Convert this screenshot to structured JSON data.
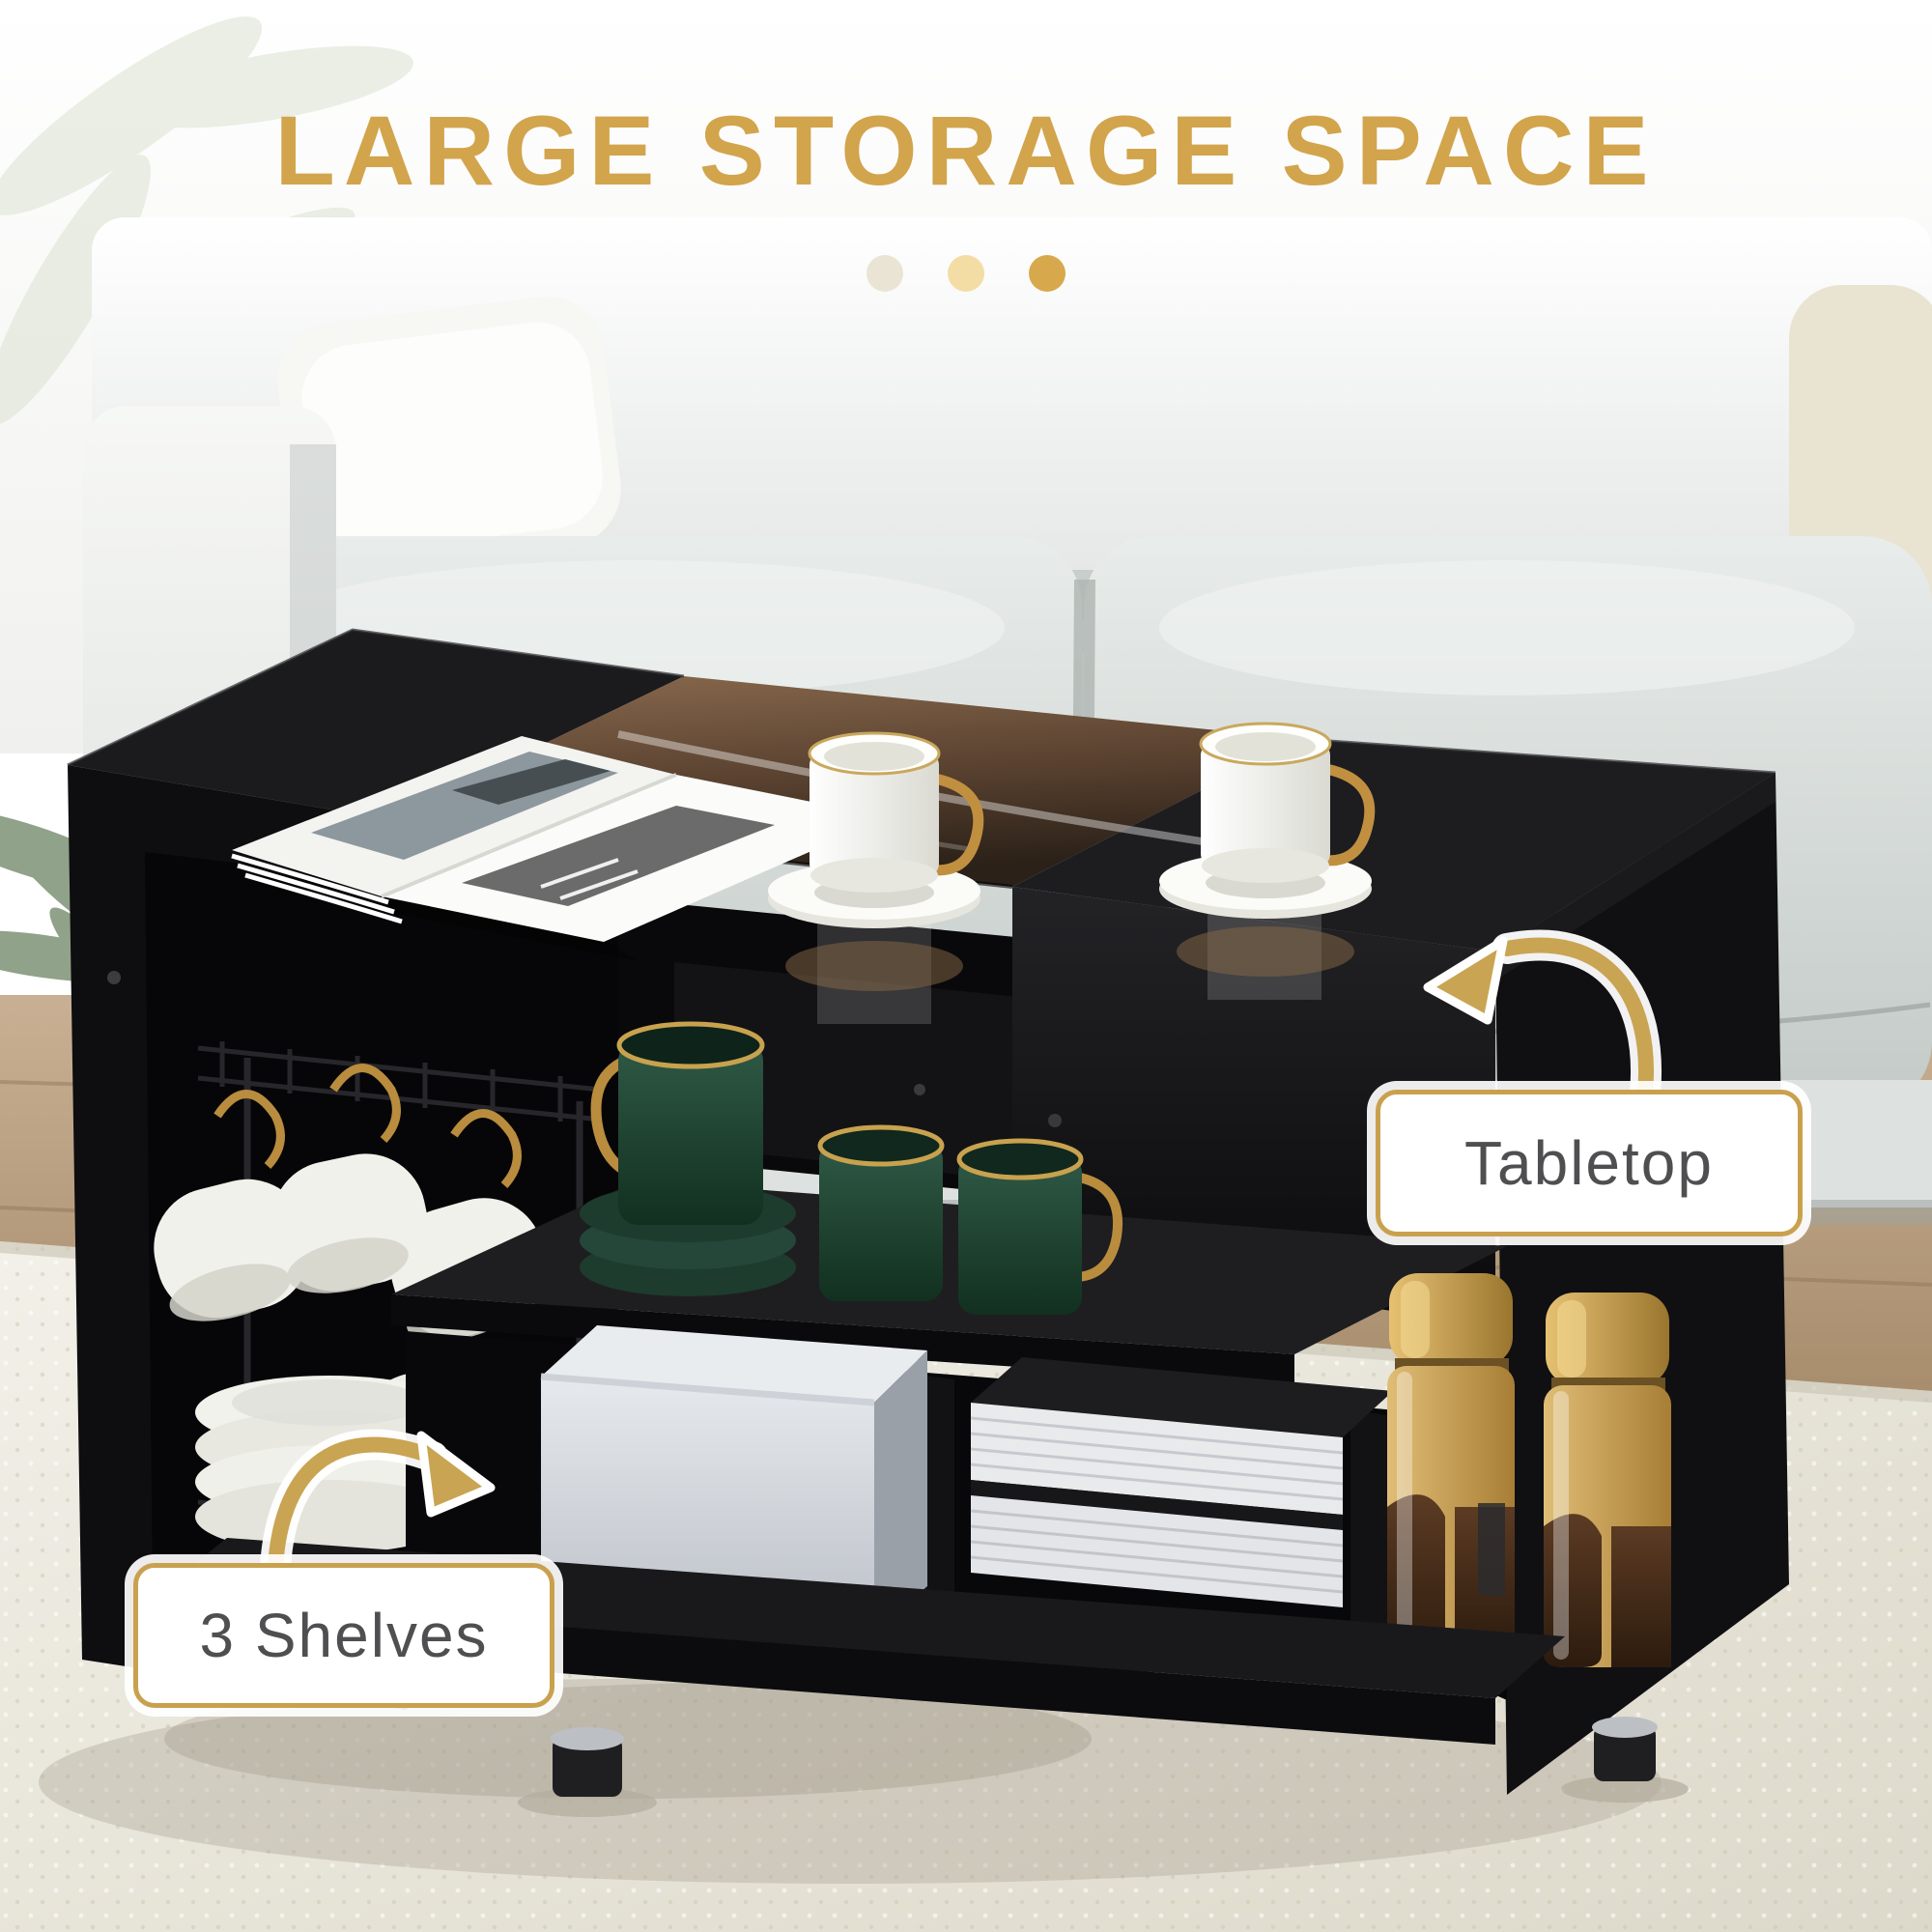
{
  "header": {
    "title": "LARGE STORAGE SPACE"
  },
  "progress_dots": [
    "#EAE4D4",
    "#F4DDA4",
    "#D8A94C"
  ],
  "callouts": {
    "tabletop": "Tabletop",
    "shelves": "3 Shelves"
  },
  "colors": {
    "accent": "#D2A44C",
    "label_border": "#C9A14E",
    "label_text": "#4F4F51",
    "arrow": "#C9A452"
  }
}
